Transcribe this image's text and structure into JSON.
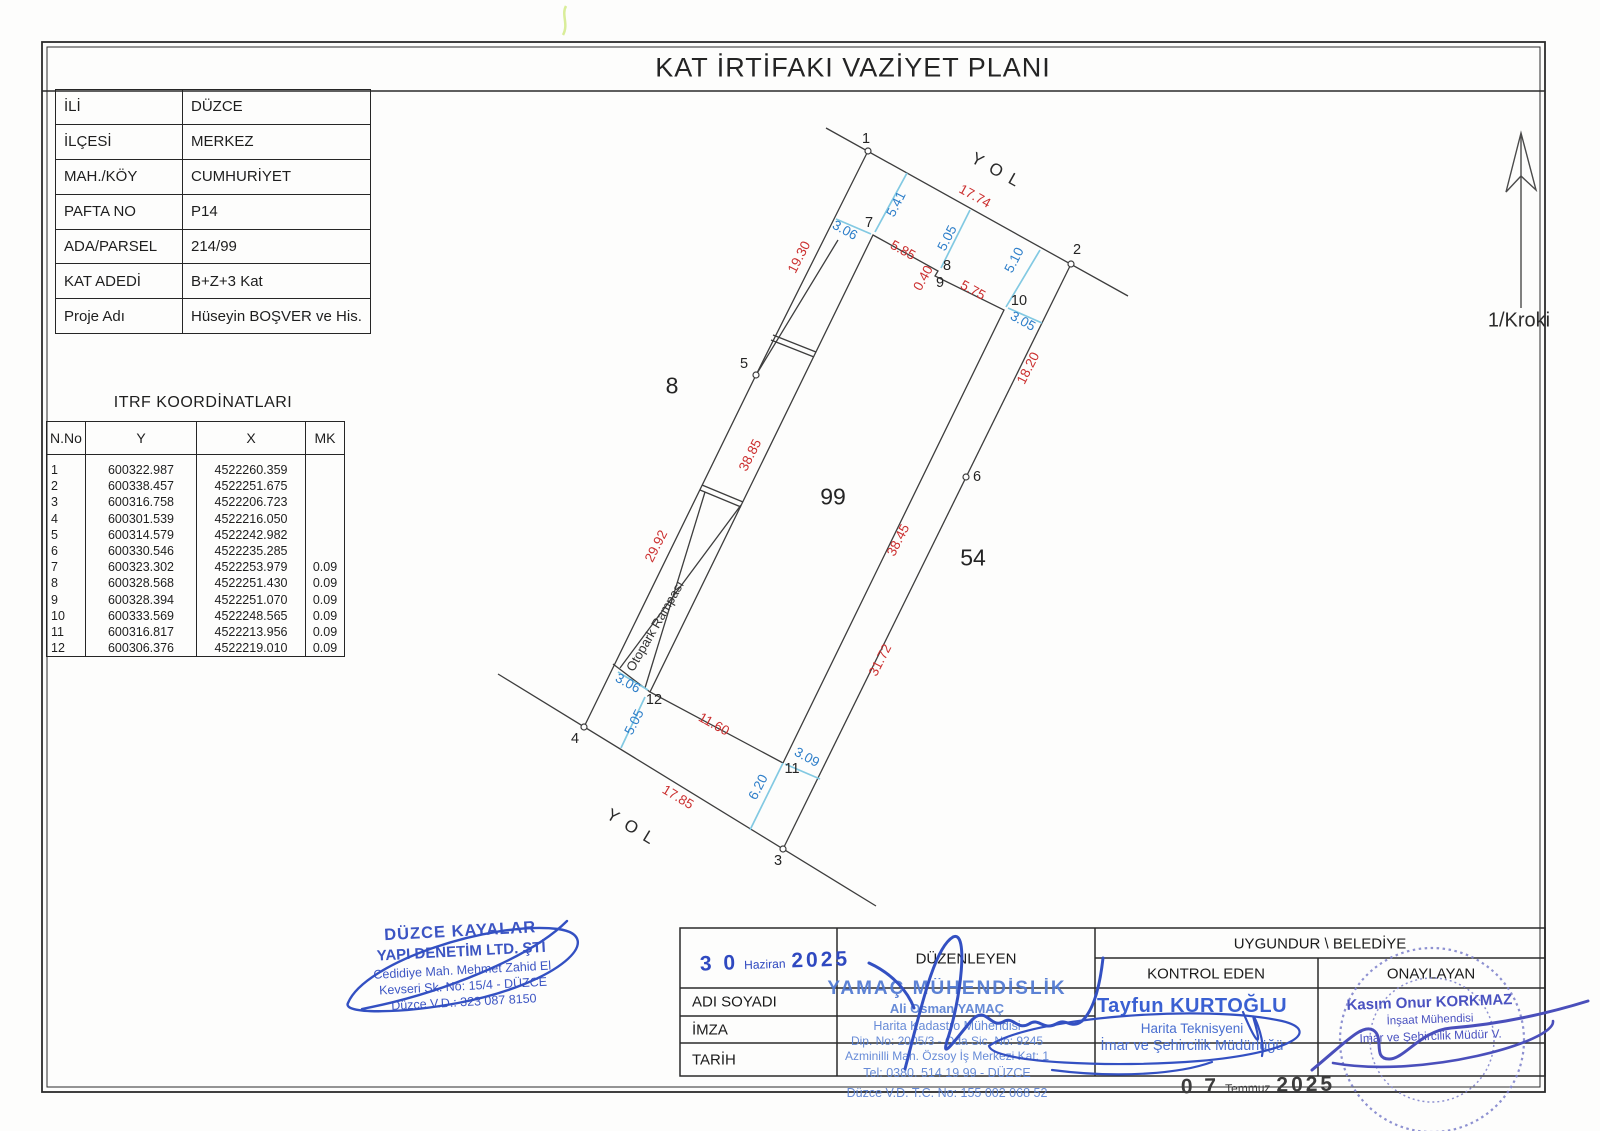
{
  "title": "KAT İRTİFAKI VAZİYET PLANI",
  "north_label": "1/Kroki",
  "info_table": {
    "rows": [
      {
        "label": "İLİ",
        "value": "DÜZCE"
      },
      {
        "label": "İLÇESİ",
        "value": "MERKEZ"
      },
      {
        "label": "MAH./KÖY",
        "value": "CUMHURİYET"
      },
      {
        "label": "PAFTA NO",
        "value": "P14"
      },
      {
        "label": "ADA/PARSEL",
        "value": "214/99"
      },
      {
        "label": "KAT ADEDİ",
        "value": "B+Z+3 Kat"
      },
      {
        "label": "Proje Adı",
        "value": "Hüseyin BOŞVER ve His."
      }
    ]
  },
  "itrf_table": {
    "title": "ITRF KOORDİNATLARI",
    "headers": [
      "N.No",
      "Y",
      "X",
      "MK"
    ],
    "rows": [
      [
        "1",
        "600322.987",
        "4522260.359",
        ""
      ],
      [
        "2",
        "600338.457",
        "4522251.675",
        ""
      ],
      [
        "3",
        "600316.758",
        "4522206.723",
        ""
      ],
      [
        "4",
        "600301.539",
        "4522216.050",
        ""
      ],
      [
        "5",
        "600314.579",
        "4522242.982",
        ""
      ],
      [
        "6",
        "600330.546",
        "4522235.285",
        ""
      ],
      [
        "7",
        "600323.302",
        "4522253.979",
        "0.09"
      ],
      [
        "8",
        "600328.568",
        "4522251.430",
        "0.09"
      ],
      [
        "9",
        "600328.394",
        "4522251.070",
        "0.09"
      ],
      [
        "10",
        "600333.569",
        "4522248.565",
        "0.09"
      ],
      [
        "11",
        "600316.817",
        "4522213.956",
        "0.09"
      ],
      [
        "12",
        "600306.376",
        "4522219.010",
        "0.09"
      ]
    ]
  },
  "plan": {
    "labels": [
      {
        "t": "17.74",
        "x": 975,
        "y": 196,
        "r": 29,
        "c": "red",
        "n": "dim-red"
      },
      {
        "t": "19.30",
        "x": 799,
        "y": 257,
        "r": -63,
        "c": "red",
        "n": "dim-red"
      },
      {
        "t": "29.92",
        "x": 656,
        "y": 546,
        "r": -63,
        "c": "red",
        "n": "dim-red"
      },
      {
        "t": "17.85",
        "x": 678,
        "y": 797,
        "r": 31,
        "c": "red",
        "n": "dim-red"
      },
      {
        "t": "18.20",
        "x": 1028,
        "y": 368,
        "r": -63,
        "c": "red",
        "n": "dim-red"
      },
      {
        "t": "31.72",
        "x": 880,
        "y": 660,
        "r": -63,
        "c": "red",
        "n": "dim-red"
      },
      {
        "t": "5.85",
        "x": 903,
        "y": 250,
        "r": 29,
        "c": "red",
        "n": "dim-red"
      },
      {
        "t": "0.40",
        "x": 923,
        "y": 278,
        "r": -61,
        "c": "red",
        "n": "dim-red"
      },
      {
        "t": "5.75",
        "x": 973,
        "y": 290,
        "r": 29,
        "c": "red",
        "n": "dim-red"
      },
      {
        "t": "38.85",
        "x": 750,
        "y": 455,
        "r": -63,
        "c": "red",
        "n": "dim-red"
      },
      {
        "t": "38.45",
        "x": 898,
        "y": 540,
        "r": -63,
        "c": "red",
        "n": "dim-red"
      },
      {
        "t": "11.60",
        "x": 714,
        "y": 724,
        "r": 29,
        "c": "red",
        "n": "dim-red"
      },
      {
        "t": "5.41",
        "x": 896,
        "y": 204,
        "r": -63,
        "c": "blue",
        "n": "dim-blue"
      },
      {
        "t": "3.06",
        "x": 845,
        "y": 230,
        "r": 29,
        "c": "blue",
        "n": "dim-blue"
      },
      {
        "t": "5.05",
        "x": 947,
        "y": 238,
        "r": -63,
        "c": "blue",
        "n": "dim-blue"
      },
      {
        "t": "5.10",
        "x": 1014,
        "y": 260,
        "r": -63,
        "c": "blue",
        "n": "dim-blue"
      },
      {
        "t": "3.05",
        "x": 1023,
        "y": 321,
        "r": 29,
        "c": "blue",
        "n": "dim-blue"
      },
      {
        "t": "3.06",
        "x": 628,
        "y": 683,
        "r": 29,
        "c": "blue",
        "n": "dim-blue"
      },
      {
        "t": "5.05",
        "x": 634,
        "y": 722,
        "r": -63,
        "c": "blue",
        "n": "dim-blue"
      },
      {
        "t": "3.09",
        "x": 807,
        "y": 757,
        "r": 29,
        "c": "blue",
        "n": "dim-blue"
      },
      {
        "t": "6.20",
        "x": 758,
        "y": 787,
        "r": -63,
        "c": "blue",
        "n": "dim-blue"
      },
      {
        "t": "1",
        "x": 866,
        "y": 139,
        "r": 0,
        "c": "pt",
        "n": "point-number"
      },
      {
        "t": "2",
        "x": 1077,
        "y": 250,
        "r": 0,
        "c": "pt",
        "n": "point-number"
      },
      {
        "t": "3",
        "x": 778,
        "y": 861,
        "r": 0,
        "c": "pt",
        "n": "point-number"
      },
      {
        "t": "4",
        "x": 575,
        "y": 739,
        "r": 0,
        "c": "pt",
        "n": "point-number"
      },
      {
        "t": "5",
        "x": 744,
        "y": 364,
        "r": 0,
        "c": "pt",
        "n": "point-number"
      },
      {
        "t": "6",
        "x": 977,
        "y": 477,
        "r": 0,
        "c": "pt",
        "n": "point-number"
      },
      {
        "t": "7",
        "x": 869,
        "y": 223,
        "r": 0,
        "c": "pt",
        "n": "point-number"
      },
      {
        "t": "8",
        "x": 947,
        "y": 266,
        "r": 0,
        "c": "pt",
        "n": "point-number"
      },
      {
        "t": "9",
        "x": 940,
        "y": 283,
        "r": 0,
        "c": "pt",
        "n": "point-number"
      },
      {
        "t": "10",
        "x": 1019,
        "y": 301,
        "r": 0,
        "c": "pt",
        "n": "point-number"
      },
      {
        "t": "11",
        "x": 792,
        "y": 769,
        "r": 0,
        "c": "pt",
        "n": "point-number"
      },
      {
        "t": "12",
        "x": 654,
        "y": 700,
        "r": 0,
        "c": "pt",
        "n": "point-number"
      },
      {
        "t": "8",
        "x": 672,
        "y": 386,
        "r": 0,
        "c": "parcel",
        "n": "parcel-number"
      },
      {
        "t": "99",
        "x": 833,
        "y": 497,
        "r": 0,
        "c": "parcel",
        "n": "parcel-number"
      },
      {
        "t": "54",
        "x": 973,
        "y": 558,
        "r": 0,
        "c": "parcel",
        "n": "parcel-number"
      },
      {
        "t": "YOL",
        "x": 999,
        "y": 172,
        "r": 29,
        "c": "road",
        "n": "road-label"
      },
      {
        "t": "YOL",
        "x": 634,
        "y": 829,
        "r": 31,
        "c": "road",
        "n": "road-label"
      },
      {
        "t": "Otopark Rampası",
        "x": 655,
        "y": 626,
        "r": -60,
        "c": "ramp",
        "n": "ramp-label"
      }
    ]
  },
  "bottom_table": {
    "duzenleyen": "DÜZENLEYEN",
    "uygundur": "UYGUNDUR \\ BELEDİYE",
    "kontrol_eden": "KONTROL EDEN",
    "onaylayan": "ONAYLAYAN",
    "adi_soyadi": "ADI SOYADI",
    "imza": "İMZA",
    "tarih": "TARİH"
  },
  "stamps": {
    "date1": {
      "day": "3 0",
      "month": "Haziran",
      "year": "2025"
    },
    "date2": {
      "day": "0 7",
      "month": "Temmuz",
      "year": "2025"
    },
    "kayalar": {
      "line1": "DÜZCE KAYALAR",
      "line2": "YAPI DENETİM LTD. ŞTİ",
      "line3": "Cedidiye Mah. Mehmet Zahid El",
      "line4": "Kevseri Sk. No: 15/4 - DÜZCE",
      "line5": "Düzce V.D.: 323 087 8150"
    },
    "yamac": {
      "line1": "YAMAÇ MÜHENDİSLİK",
      "line2": "Ali Osman YAMAÇ",
      "line3": "Harita Kadastro Mühendisi",
      "line4": "Dip. No: 2005/3 - Oda Sic. No: 9245",
      "line5": "Azminilli Mah. Özsoy İş Merkezi Kat: 1",
      "line6": "Tel: 0380. 514 19 99 - DÜZCE",
      "line7": "Düzce V.D. T.C. No: 155 002 068 52"
    },
    "kurtoglu": {
      "name": "Tayfun KURTOĞLU",
      "title1": "Harita Teknisyeni",
      "title2": "İmar ve Şehircilik Müdürlüğü"
    },
    "korkmaz": {
      "name": "Kasım Onur KORKMAZ",
      "title1": "İnşaat Mühendisi",
      "title2": "İmar ve Şehircilik Müdür V."
    }
  },
  "colors": {
    "dim_red": "#cb2f2f",
    "dim_blue": "#2d7ec9",
    "tick_cyan": "#82c9e2",
    "stamp_blue": "#3c55c3",
    "stamp_purple": "#7b7fca"
  }
}
